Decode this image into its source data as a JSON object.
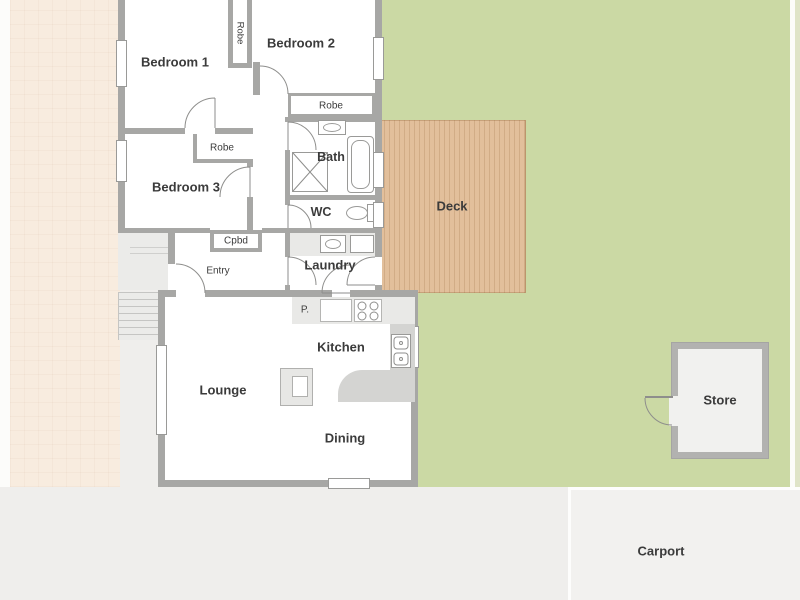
{
  "rooms": {
    "bedroom1": "Bedroom 1",
    "bedroom2": "Bedroom 2",
    "bedroom3": "Bedroom 3",
    "bath": "Bath",
    "wc": "WC",
    "laundry": "Laundry",
    "kitchen": "Kitchen",
    "lounge": "Lounge",
    "dining": "Dining",
    "entry": "Entry"
  },
  "storage": {
    "robe1": "Robe",
    "robe2": "Robe",
    "robe3": "Robe",
    "cupboard": "Cpbd",
    "pantry": "P."
  },
  "outdoor": {
    "deck": "Deck",
    "store": "Store",
    "carport": "Carport"
  },
  "colors": {
    "bg": "#efeeec",
    "driveway": "#f8ecdf",
    "grass": "#cbd9a4",
    "grassPale": "#dfe4c8",
    "deck": "#e2bf9b",
    "wall": "#a7a7a5",
    "porch": "#ebebe9",
    "bench": "#e9e9e7",
    "counter": "#d4d4d2",
    "carport": "#f2f1ef",
    "storeFill": "#f1f1ef",
    "text": "#3b3b3b",
    "fixture": "#9a9a98"
  }
}
